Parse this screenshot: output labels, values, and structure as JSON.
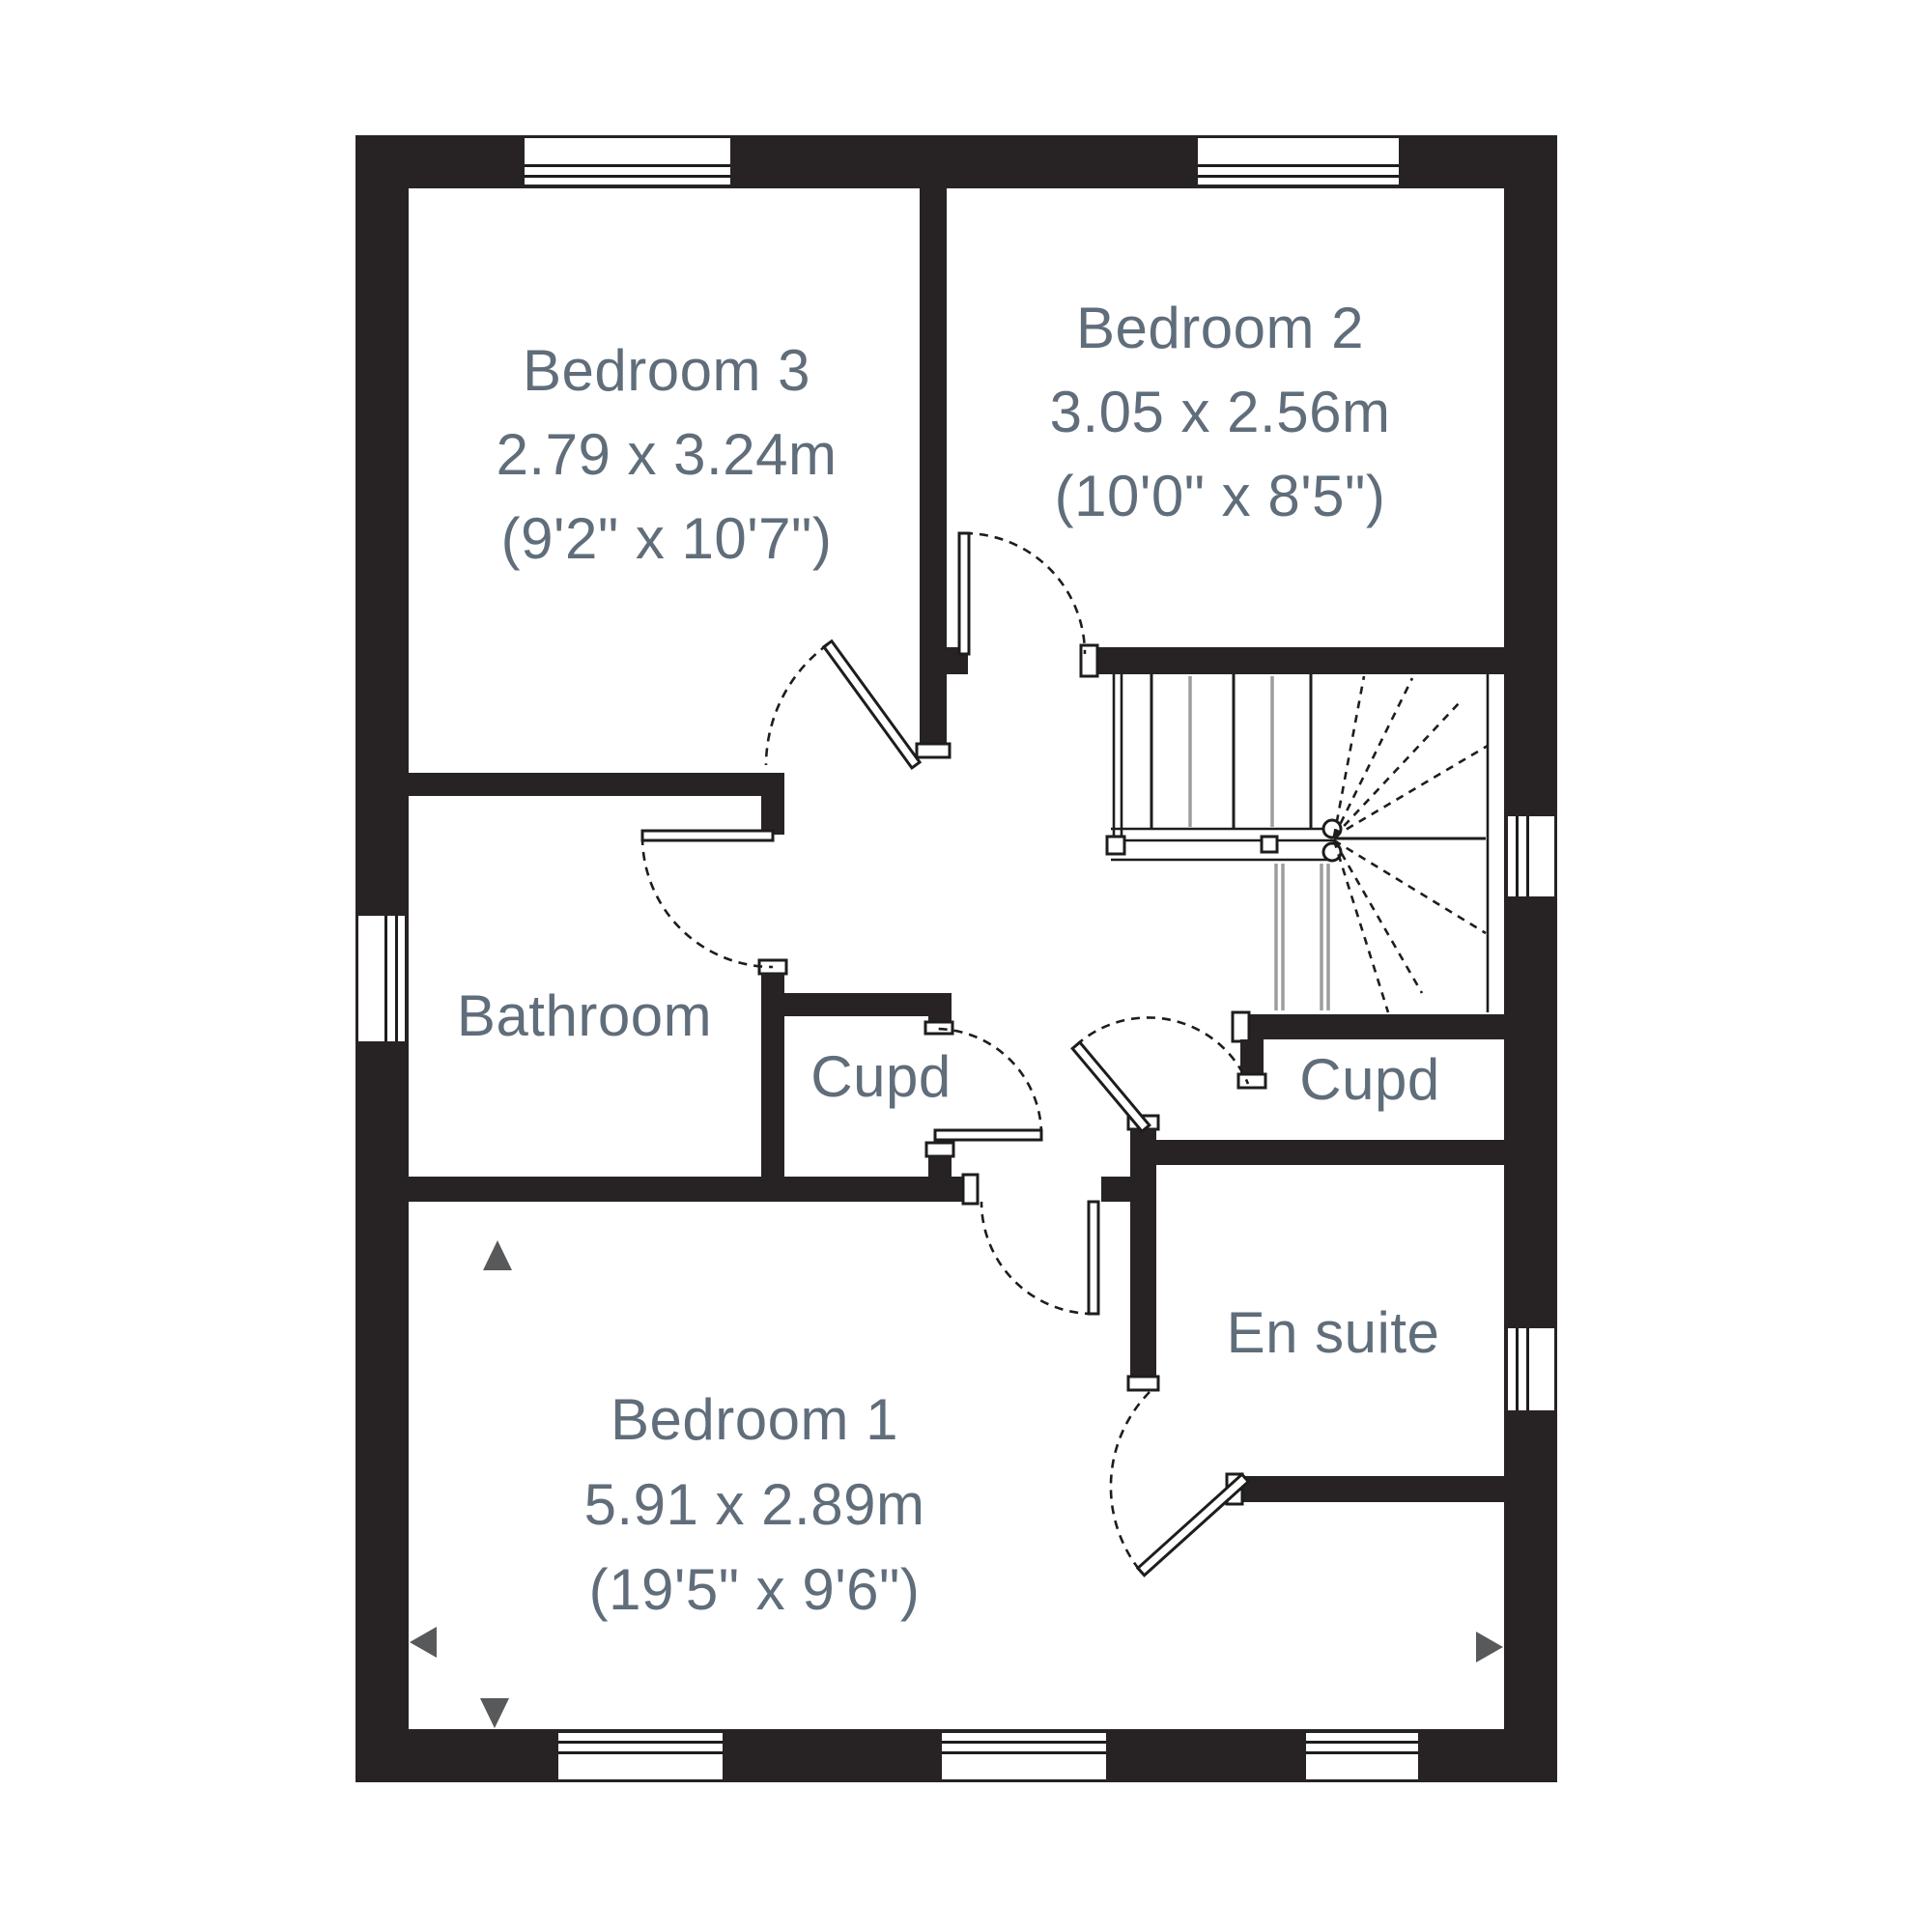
{
  "floorplan": {
    "title": "First floor plan",
    "rooms": [
      {
        "name": "Bedroom 3",
        "size_metric": "2.79 x 3.24m",
        "size_imperial": "(9'2\" x 10'7\")"
      },
      {
        "name": "Bedroom 2",
        "size_metric": "3.05 x 2.56m",
        "size_imperial": "(10'0\" x 8'5\")"
      },
      {
        "name": "Bathroom"
      },
      {
        "name": "Cupd"
      },
      {
        "name": "Cupd"
      },
      {
        "name": "En suite"
      },
      {
        "name": "Bedroom 1",
        "size_metric": "5.91 x 2.89m",
        "size_imperial": "(19'5\" x 9'6\")"
      }
    ],
    "colors": {
      "wall": "#272324",
      "line": "#1d1d1b",
      "light_line": "#9d9d9c",
      "label_text": "#606d7a",
      "marker": "#58595b",
      "background": "#ffffff"
    }
  }
}
